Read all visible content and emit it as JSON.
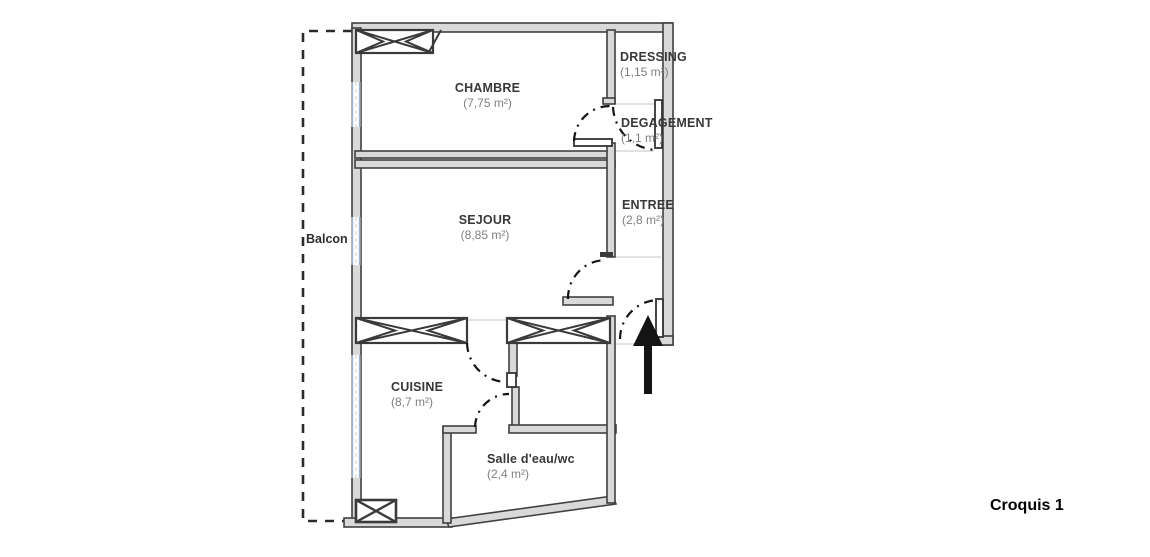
{
  "title": "Croquis 1",
  "outdoor": {
    "balcony_label": "Balcon"
  },
  "rooms": [
    {
      "id": "chambre",
      "name": "CHAMBRE",
      "area": "(7,75 m²)"
    },
    {
      "id": "dressing",
      "name": "DRESSING",
      "area": "(1,15 m²)"
    },
    {
      "id": "degagement",
      "name": "DEGAGEMENT",
      "area": "(1,1 m²)"
    },
    {
      "id": "sejour",
      "name": "SEJOUR",
      "area": "(8,85 m²)"
    },
    {
      "id": "entree",
      "name": "ENTREE",
      "area": "(2,8 m²)"
    },
    {
      "id": "cuisine",
      "name": "CUISINE",
      "area": "(8,7 m²)"
    },
    {
      "id": "salle-eau",
      "name": "Salle d'eau/wc",
      "area": "(2,4 m²)"
    }
  ],
  "colors": {
    "wall_fill": "#d9d9d9",
    "wall_stroke": "#404040",
    "room_name_text": "#383838",
    "room_area_text": "#7f7f7f",
    "window_glass": "#9fb3cf",
    "floor_line": "#d8d8d8",
    "door_arc": "#141414",
    "entrance_arrow": "#141414",
    "balcony_dash": "#2b2b2b"
  },
  "symbols": {
    "window_symbol": "crossed-box-window",
    "door_symbol": "dash-dot-quarter-arc",
    "entrance_symbol": "up-arrow"
  }
}
